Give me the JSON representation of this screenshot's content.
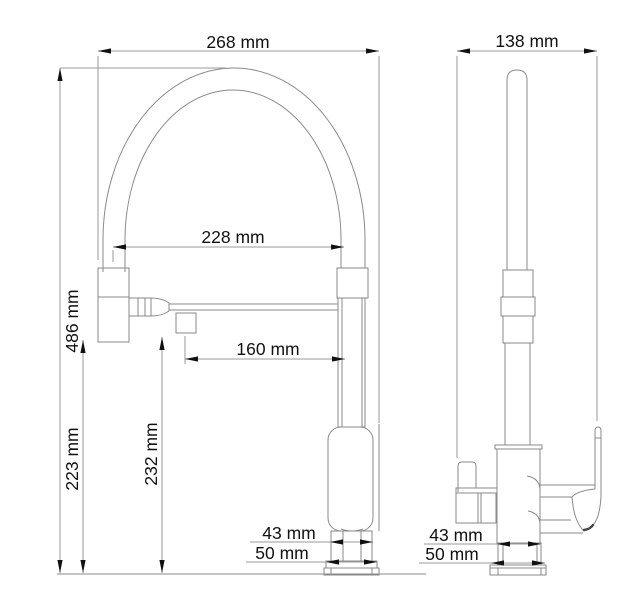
{
  "drawing": {
    "type": "technical-dimension-drawing",
    "subject": "kitchen faucet with flexible spring spout, two orthographic views",
    "unit": "mm",
    "colors": {
      "background": "#ffffff",
      "object_line": "#8a8a8a",
      "dimension_line": "#9a9a9a",
      "text": "#111111"
    },
    "front": {
      "dims": {
        "overall_width": "268 mm",
        "spout_reach": "228 mm",
        "overall_height": "486 mm",
        "outlet_reach": "160 mm",
        "spray_head_height": "223 mm",
        "outlet_height": "232 mm",
        "base_top_width": "43 mm",
        "base_width": "50 mm"
      }
    },
    "side": {
      "dims": {
        "overall_depth": "138 mm",
        "base_top_depth": "43 mm",
        "base_depth": "50 mm"
      }
    }
  }
}
